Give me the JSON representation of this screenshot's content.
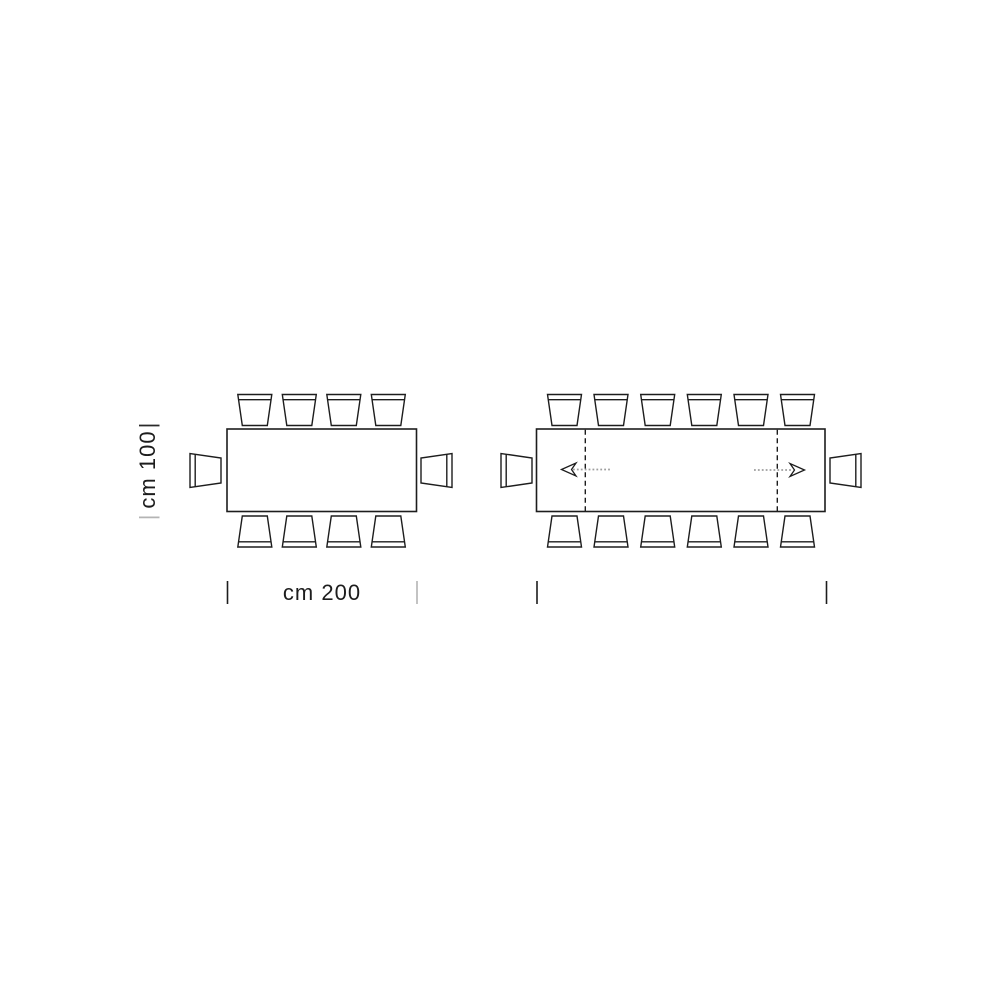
{
  "colors": {
    "line": "#1d1d1d",
    "dotted_gray": "#9e9e9e",
    "tick_gray": "#b4b4b4",
    "background": "#ffffff"
  },
  "left_diagram": {
    "height_label": {
      "bottom_tick": "|",
      "text": "cm 100",
      "top_tick": "|"
    },
    "width_label": {
      "text": "cm 200"
    },
    "table_size_cm": {
      "width": 200,
      "depth": 100
    },
    "seats": {
      "top": 4,
      "bottom": 4,
      "ends": 2,
      "total": 10
    }
  },
  "right_diagram": {
    "seats": {
      "top": 6,
      "bottom": 6,
      "ends": 2,
      "total": 14
    },
    "extension_leaves": 2,
    "arrow_directions": [
      "left",
      "right"
    ]
  }
}
